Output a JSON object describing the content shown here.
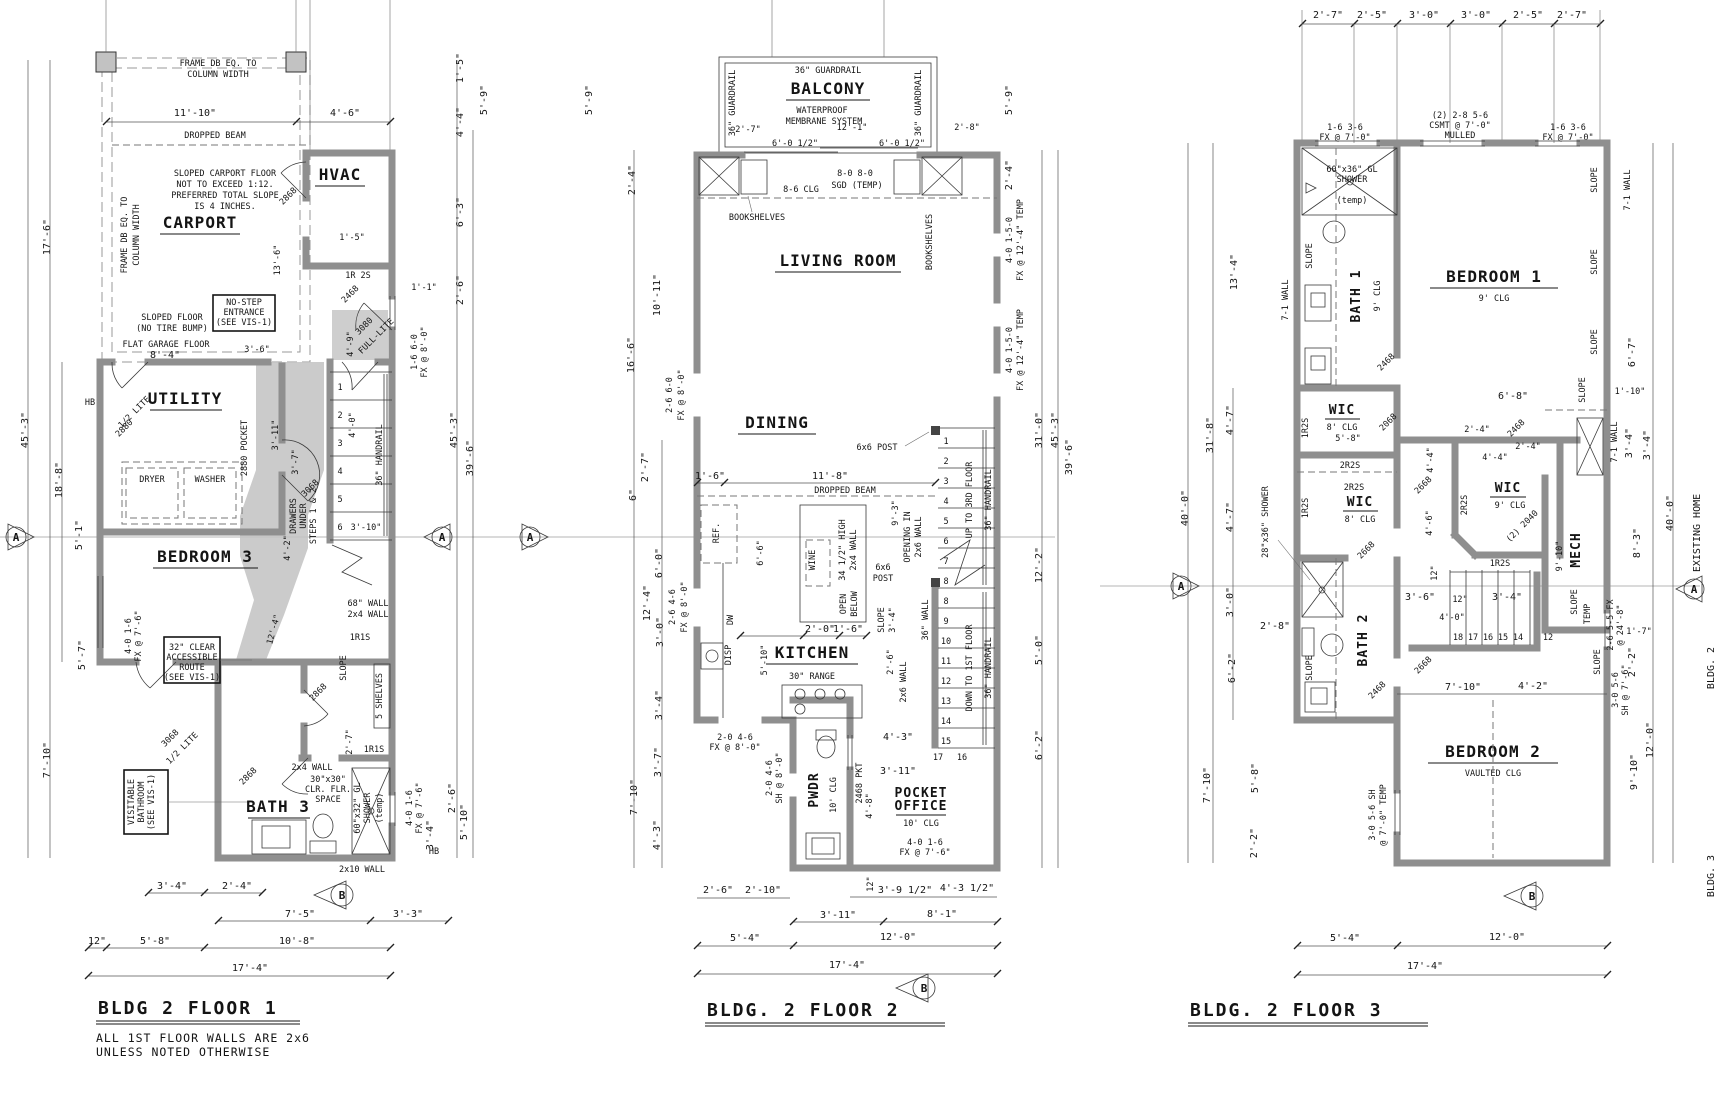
{
  "m": {
    "a": "A",
    "b": "B"
  },
  "f1": {
    "t": "BLDG 2 FLOOR 1",
    "n1": "ALL 1ST FLOOR WALLS ARE 2x6",
    "n2": "UNLESS NOTED OTHERWISE",
    "r": {
      "carport": "CARPORT",
      "hvac": "HVAC",
      "utility": "UTILITY",
      "bedroom3": "BEDROOM 3",
      "bath3": "BATH 3"
    },
    "L": {
      "fr1": "FRAME DB EQ. TO",
      "fr2": "COLUMN WIDTH",
      "beam": "DROPPED BEAM",
      "sc1": "SLOPED CARPORT FLOOR",
      "sc2": "NOT TO EXCEED 1:12.",
      "sc3": "PREFERRED TOTAL SLOPE",
      "sc4": "IS 4 INCHES.",
      "ns1": "NO-STEP",
      "ns2": "ENTRANCE",
      "ns3": "(SEE VIS-1)",
      "sf1": "SLOPED FLOOR",
      "sf2": "(NO TIRE BUMP)",
      "flat": "FLAT GARAGE FLOOR",
      "dryer": "DRYER",
      "washer": "WASHER",
      "pocket": "2880 POCKET",
      "d2880": "2880",
      "halflite": "1/2 LITE",
      "d2868": "2868",
      "d2468": "2468",
      "d3080": "3080",
      "fullite": "FULL-LITE",
      "d3068": "3068",
      "ir2s": "1R 2S",
      "hb": "HB",
      "dr1": "DRAWERS",
      "dr2": "UNDER",
      "dr3": "STEPS 1 & 2",
      "handrail": "36\" HANDRAIL",
      "st": [
        "1",
        "2",
        "3",
        "4",
        "5",
        "6"
      ],
      "w68": "68\" WALL",
      "w2x4": "2x4 WALL",
      "r1s": "1R1S",
      "slope": "SLOPE",
      "shelves": "5 SHELVES",
      "acc1": "32\" CLEAR",
      "acc2": "ACCESSIBLE",
      "acc3": "ROUTE",
      "acc4": "(SEE VIS-1)",
      "vis1": "VISITABLE",
      "vis2": "BATHROOM",
      "vis3": "(SEE VIS-1)",
      "clr1": "30\"x30\"",
      "clr2": "CLR. FLR.",
      "clr3": "SPACE",
      "sh1": "60\"x32\" GL",
      "sh2": "SHOWER",
      "temp": "(temp)",
      "w2x10": "2x10 WALL",
      "winA1": "4-0 1-6",
      "winA2": "FX @ 7'-6\"",
      "winB1": "1-6 6-0",
      "winB2": "FX @ 8'-0\""
    },
    "dt": [
      "11'-10\"",
      "4'-6\""
    ],
    "db1": [
      "3'-4\"",
      "2'-4\""
    ],
    "db2": [
      "7'-5\"",
      "3'-3\""
    ],
    "db3": [
      "12\"",
      "5'-8\"",
      "10'-8\""
    ],
    "db4": [
      "17'-4\""
    ],
    "dl": [
      "45'-3\"",
      "17'-6\"",
      "18'-8\"",
      "5'-1\"",
      "5'-7\"",
      "7'-10\""
    ],
    "dr": [
      "1'-5\"",
      "5'-9\"",
      "4'-4\"",
      "6'-3\"",
      "2'-6\"",
      "1'-1\"",
      "45'-3\"",
      "39'-6\"",
      "2'-6\"",
      "5'-10\"",
      "3'-4\"",
      "4'-0\""
    ],
    "di": [
      "13'-6\"",
      "3'-6\"",
      "8'-4\"",
      "4'-9\"",
      "1'-5\"",
      "3'-11\"",
      "3'-7\"",
      "4'-2\"",
      "12'-4\"",
      "2'-7\"",
      "3'-10\""
    ]
  },
  "f2": {
    "t": "BLDG. 2 FLOOR 2",
    "r": {
      "balcony": "BALCONY",
      "living": "LIVING ROOM",
      "dining": "DINING",
      "kitchen": "KITCHEN",
      "pwdr": "PWDR",
      "office1": "POCKET",
      "office2": "OFFICE"
    },
    "L": {
      "guardrail": "36\" GUARDRAIL",
      "wp1": "WATERPROOF",
      "wp2": "MEMBRANE SYSTEM",
      "sgd1": "8-0 8-0",
      "sgd2": "SGD (TEMP)",
      "clg86": "8-6 CLG",
      "books": "BOOKSHELVES",
      "post": "6x6 POST",
      "postB1": "6x6",
      "postB2": "POST",
      "beam": "DROPPED BEAM",
      "open1": "OPENING IN",
      "open2": "2x6 WALL",
      "up": "UP TO 3RD FLOOR",
      "down": "DOWN TO 1ST FLOOR",
      "handrail": "36\" HANDRAIL",
      "w36": "36\" WALL",
      "w2x6": "2x6 WALL",
      "ref": "REF.",
      "dw": "DW",
      "disp": "DISP",
      "wine": "WINE",
      "high1": "34 1/2\" HIGH",
      "high2": "2x4 WALL",
      "ob1": "OPEN",
      "ob2": "BELOW",
      "range": "30\" RANGE",
      "clg10": "10' CLG",
      "pkt": "2468 PKT",
      "slope": "SLOPE",
      "stU": [
        "1",
        "2",
        "3",
        "4",
        "5",
        "6",
        "7",
        "8"
      ],
      "stD": [
        "8",
        "9",
        "10",
        "11",
        "12",
        "13",
        "14",
        "15"
      ],
      "st16": "16",
      "st17": "17",
      "winK1": "2-0 4-6",
      "winK2": "FX @ 8'-0\"",
      "winP1": "2-0 4-6",
      "winP2": "SH @ 8'-0\"",
      "winO1": "4-0 1-6",
      "winO2": "FX @ 7'-6\"",
      "winL1": "2-6 6-0",
      "winL2": "FX @ 8'-0\"",
      "winL3": "2-6 4-6",
      "winR1": "4-0 1-5-0",
      "winR2": "FX @ 12'-4\" TEMP"
    },
    "dt": [
      "2'-7\"",
      "12'-1\"",
      "6'-0 1/2\"",
      "6'-0 1/2\"",
      "2'-8\""
    ],
    "db1": [
      "2'-6\"",
      "2'-10\"",
      "12\"",
      "3'-9 1/2\"",
      "4'-3 1/2\""
    ],
    "db2": [
      "3'-11\"",
      "8'-1\""
    ],
    "db3": [
      "5'-4\"",
      "12'-0\""
    ],
    "db4": [
      "17'-4\""
    ],
    "dl": [
      "5'-9\"",
      "2'-4\"",
      "10'-11\"",
      "16'-6\"",
      "2'-7\"",
      "6\"",
      "6'-0\"",
      "12'-4\"",
      "3'-0\"",
      "3'-4\"",
      "3'-7\"",
      "7'-10\"",
      "4'-3\""
    ],
    "dr": [
      "5'-9\"",
      "2'-4\"",
      "31'-0\"",
      "45'-3\"",
      "39'-6\"",
      "12'-2\"",
      "5'-0\"",
      "6'-2\"",
      "2'-6\""
    ],
    "di": [
      "1'-6\"",
      "11'-8\"",
      "6'-6\"",
      "5'-10\"",
      "2'-0\"",
      "1'-6\"",
      "9'-3\"",
      "4'-3\"",
      "3'-11\"",
      "4'-8\"",
      "3'-4\""
    ]
  },
  "f3": {
    "t": "BLDG. 2 FLOOR 3",
    "r": {
      "bath1": "BATH 1",
      "bed1": "BEDROOM 1",
      "wic": "WIC",
      "bath2": "BATH 2",
      "mech": "MECH",
      "bed2": "BEDROOM 2"
    },
    "L": {
      "clg9": "9' CLG",
      "clg8": "8' CLG",
      "vclg": "VAULTED CLG",
      "winT1": "1-6 3-6",
      "winT2": "FX @ 7'-0\"",
      "cs1": "(2) 2-8 5-6",
      "cs2": "CSMT @ 7'-0\"",
      "cs3": "MULLED",
      "sh601": "60\"x36\" GL",
      "sh602": "SHOWER",
      "temp": "(temp)",
      "tempU": "TEMP",
      "sh28": "28\"x36\" SHOWER",
      "slope": "SLOPE",
      "wall71": "7-1 WALL",
      "r12s": "1R2S",
      "r22s": "2R2S",
      "d2468": "2468",
      "d2068": "2068",
      "d2668": "2668",
      "d2040": "(2) 2040",
      "st": [
        "18",
        "17",
        "16",
        "15",
        "14"
      ],
      "st12": "12",
      "winB1": "3-0 5-6 SH",
      "winB2": "@ 7'-0\" TEMP",
      "winR1": "2-6 5-5 FX",
      "winR2": "@ 24'-8\"",
      "winR3": "3-0 5-6",
      "winR4": "SH @ 7'-6\"",
      "existing": "EXISTING HOME",
      "bldg2": "BLDG. 2",
      "bldg3": "BLDG. 3"
    },
    "dt": [
      "2'-7\"",
      "2'-5\"",
      "3'-0\"",
      "3'-0\"",
      "2'-5\"",
      "2'-7\""
    ],
    "db3": [
      "5'-4\"",
      "12'-0\""
    ],
    "db4": [
      "17'-4\""
    ],
    "dl": [
      "31'-8\"",
      "40'-0\"",
      "13'-4\"",
      "4'-7\"",
      "4'-7\"",
      "3'-0\"",
      "6'-2\"",
      "7'-10\"",
      "5'-8\"",
      "2'-2\""
    ],
    "dr": [
      "6'-7\"",
      "3'-4\"",
      "3'-4\"",
      "8'-3\"",
      "9'-10\"",
      "40'-0\"",
      "12'-0\"",
      "9'-10\"",
      "1'-7\"",
      "2'-2\""
    ],
    "di": [
      "6'-8\"",
      "2'-4\"",
      "2'-4\"",
      "4'-4\"",
      "4'-4\"",
      "4'-6\"",
      "12\"",
      "3'-6\"",
      "12\"",
      "3'-4\"",
      "4'-0\"",
      "7'-10\"",
      "4'-2\"",
      "2'-8\"",
      "5'-8\"",
      "1'-10\""
    ]
  }
}
